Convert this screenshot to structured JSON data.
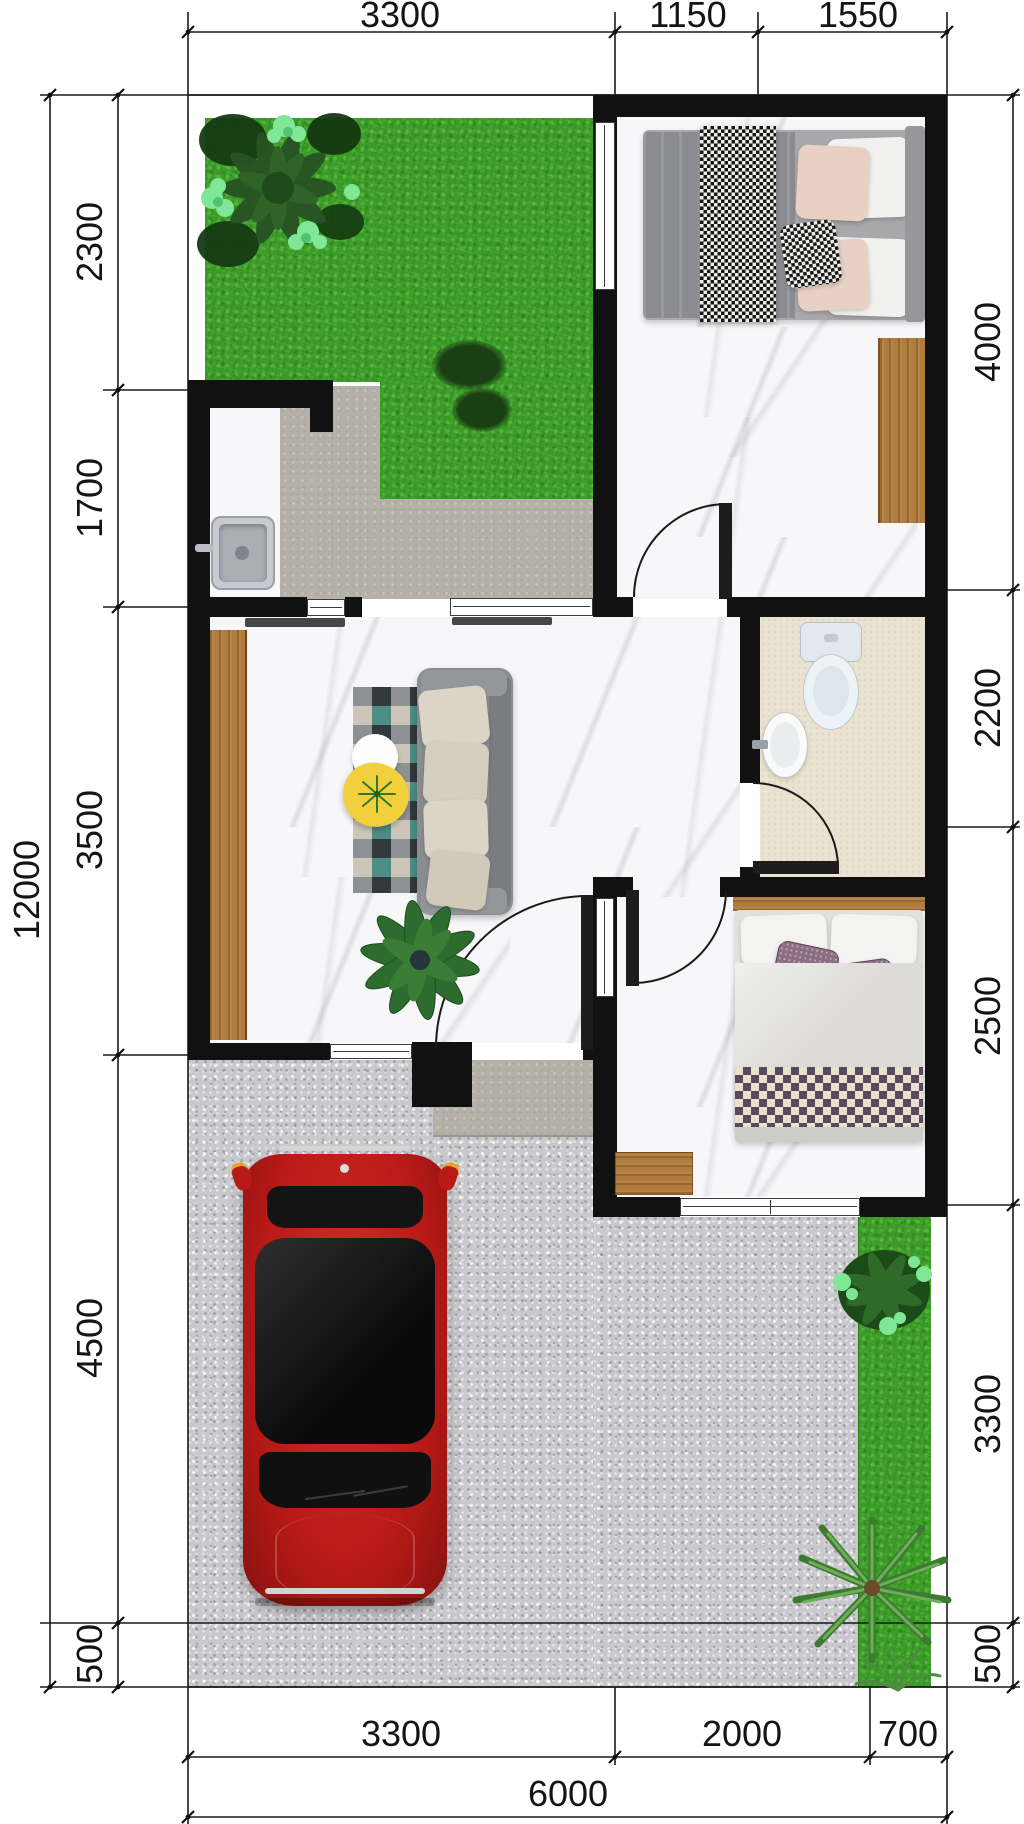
{
  "dimensions": {
    "top": [
      "3300",
      "1150",
      "1550"
    ],
    "left_overall": "12000",
    "left": [
      "2300",
      "1700",
      "3500",
      "4500",
      "500"
    ],
    "right": [
      "4000",
      "2200",
      "2500",
      "3300",
      "500"
    ],
    "bottom": [
      "3300",
      "2000",
      "700"
    ],
    "bottom_overall": "6000"
  },
  "colors": {
    "wall": "#111111",
    "dimension_line": "#1a1a1a",
    "grass": "#3c9e28",
    "gravel": "#c9c9cd",
    "concrete_path": "#b5b0a8",
    "marble_floor": "#f7f7f9",
    "bathroom_floor": "#ebe3d2",
    "wood": "#b07c3e",
    "car_red": "#c6201e",
    "rug_teal": "#4d8d86",
    "coffee_table_yellow": "#f2cf3c"
  },
  "objects": [
    "plot-boundary",
    "garden-lawn",
    "flowering-shrub",
    "moss-tuft",
    "double-bed",
    "houndstooth-throw",
    "wardrobe",
    "kitchen-sink",
    "garden-path",
    "living-room-rug",
    "sofa",
    "coffee-table",
    "side-table",
    "potted-plant",
    "toilet",
    "wash-basin",
    "single-bed",
    "checkered-blanket",
    "wood-mat",
    "entry-porch",
    "driveway",
    "car",
    "side-lawn",
    "shrub",
    "palm-tree",
    "fern"
  ]
}
